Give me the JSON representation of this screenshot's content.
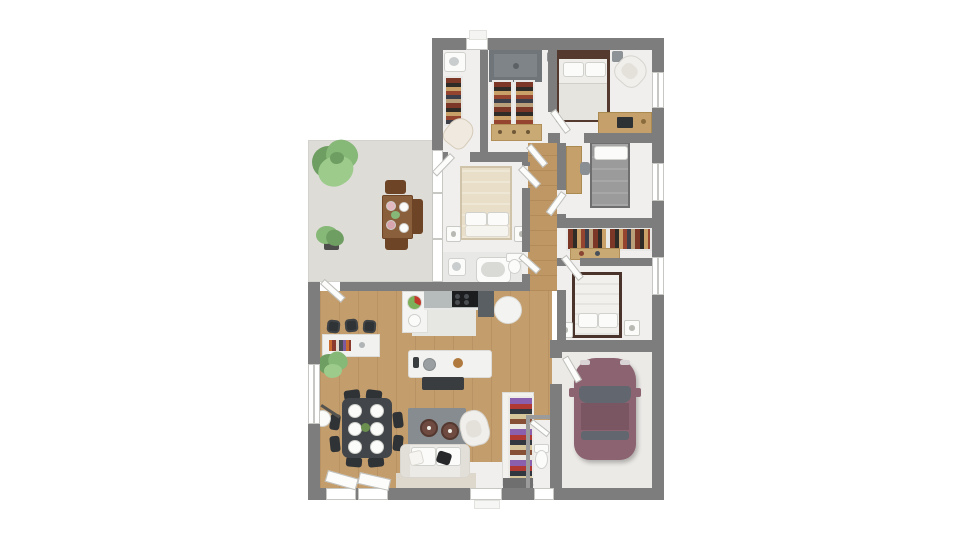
{
  "scene": {
    "description": "Top-down 3D architectural floor plan rendering of a single-storey house with outdoor terrace, four bedrooms, bathroom, open kitchen / living-dining room and a garage with one parked car",
    "canvas_width": 960,
    "canvas_height": 540,
    "visible_text": ""
  },
  "palette": {
    "wall": "#7d7d7d",
    "wall_thin": "#9b9b9b",
    "floor_white": "#f0efed",
    "floor_wood": "#c49d6c",
    "floor_wood_hall": "#bf9764",
    "terrace": "#dedcd7",
    "garage_floor": "#eceae7",
    "kitchen_floor": "#e6e6e3",
    "bath_floor": "#e8e8e6",
    "car_body": "#8c6370",
    "car_roof": "#7a5562",
    "car_glass": "#62676f",
    "bed_frame_dark": "#54392e",
    "bed_gray": "#9b9b9b",
    "bed_cream": "#e9dfc9",
    "sofa": "#eceae6",
    "cushion_black": "#26282a",
    "rug": "#868c8f",
    "pouf": "#6e4a41",
    "table_dark": "#42464a",
    "chair_dark": "#2f3336",
    "counter_gray": "#b6bbbc",
    "unit_dark": "#5a5f63",
    "cooktop": "#1b1d1f",
    "tan": "#c9a974",
    "tan_dark": "#c5a06a",
    "green_dark": "#6f9e63",
    "green_mid": "#86b877",
    "green_light": "#9ccb8b",
    "outdoor_wood": "#8a5f3c",
    "outdoor_wood_dark": "#6e4426",
    "shower": "#70757a",
    "white_fix": "#fbfbfa",
    "door_leaf": "#fcfcfb",
    "platform": "#ddd8cb",
    "shelf_base": "#6f6f6f"
  },
  "areas": [
    {
      "id": "terrace",
      "items": [
        "tree",
        "potted-plant",
        "outdoor-dining-table",
        "outdoor-chairs",
        "outdoor-bench",
        "plates"
      ]
    },
    {
      "id": "laundry-room",
      "items": [
        "washbasin",
        "clothes-rack",
        "chaise"
      ]
    },
    {
      "id": "walk-in-closet",
      "items": [
        "shower",
        "clothes-rack",
        "clothes-rack",
        "dresser"
      ]
    },
    {
      "id": "master-bedroom",
      "items": [
        "double-bed",
        "nightstand",
        "nightstand",
        "armchair",
        "desk",
        "laptop"
      ]
    },
    {
      "id": "bedroom-2",
      "items": [
        "single-bed",
        "desk",
        "chair"
      ]
    },
    {
      "id": "dressing",
      "items": [
        "clothes-rack",
        "clothes-rack",
        "shelf"
      ]
    },
    {
      "id": "bedroom-3",
      "items": [
        "double-bed",
        "nightstand",
        "nightstand"
      ]
    },
    {
      "id": "bedroom-4",
      "items": [
        "double-bed",
        "nightstand",
        "nightstand"
      ]
    },
    {
      "id": "bathroom",
      "items": [
        "bathtub",
        "toilet",
        "washbasin"
      ]
    },
    {
      "id": "kitchen",
      "items": [
        "counter",
        "cooktop",
        "tall-unit",
        "round-table",
        "island-sink",
        "bench",
        "fruit-bowl"
      ]
    },
    {
      "id": "living-dining",
      "items": [
        "bar-sideboard",
        "bar-stool",
        "bar-stool",
        "bar-stool",
        "plant",
        "dining-table",
        "dining-chairs",
        "floor-lamp",
        "rug",
        "pouf",
        "pouf",
        "armchair",
        "sofa",
        "black-cushion"
      ]
    },
    {
      "id": "entry",
      "items": [
        "front-door",
        "bookshelf"
      ]
    },
    {
      "id": "wc",
      "items": [
        "toilet"
      ]
    },
    {
      "id": "garage",
      "items": [
        "car"
      ]
    },
    {
      "id": "hallway",
      "items": []
    }
  ],
  "counts": {
    "bedrooms": 4,
    "bathrooms": 1,
    "toilets": 2,
    "parked_cars": 1,
    "trees": 1,
    "potted_plants": 2,
    "dining_plates": 6
  }
}
